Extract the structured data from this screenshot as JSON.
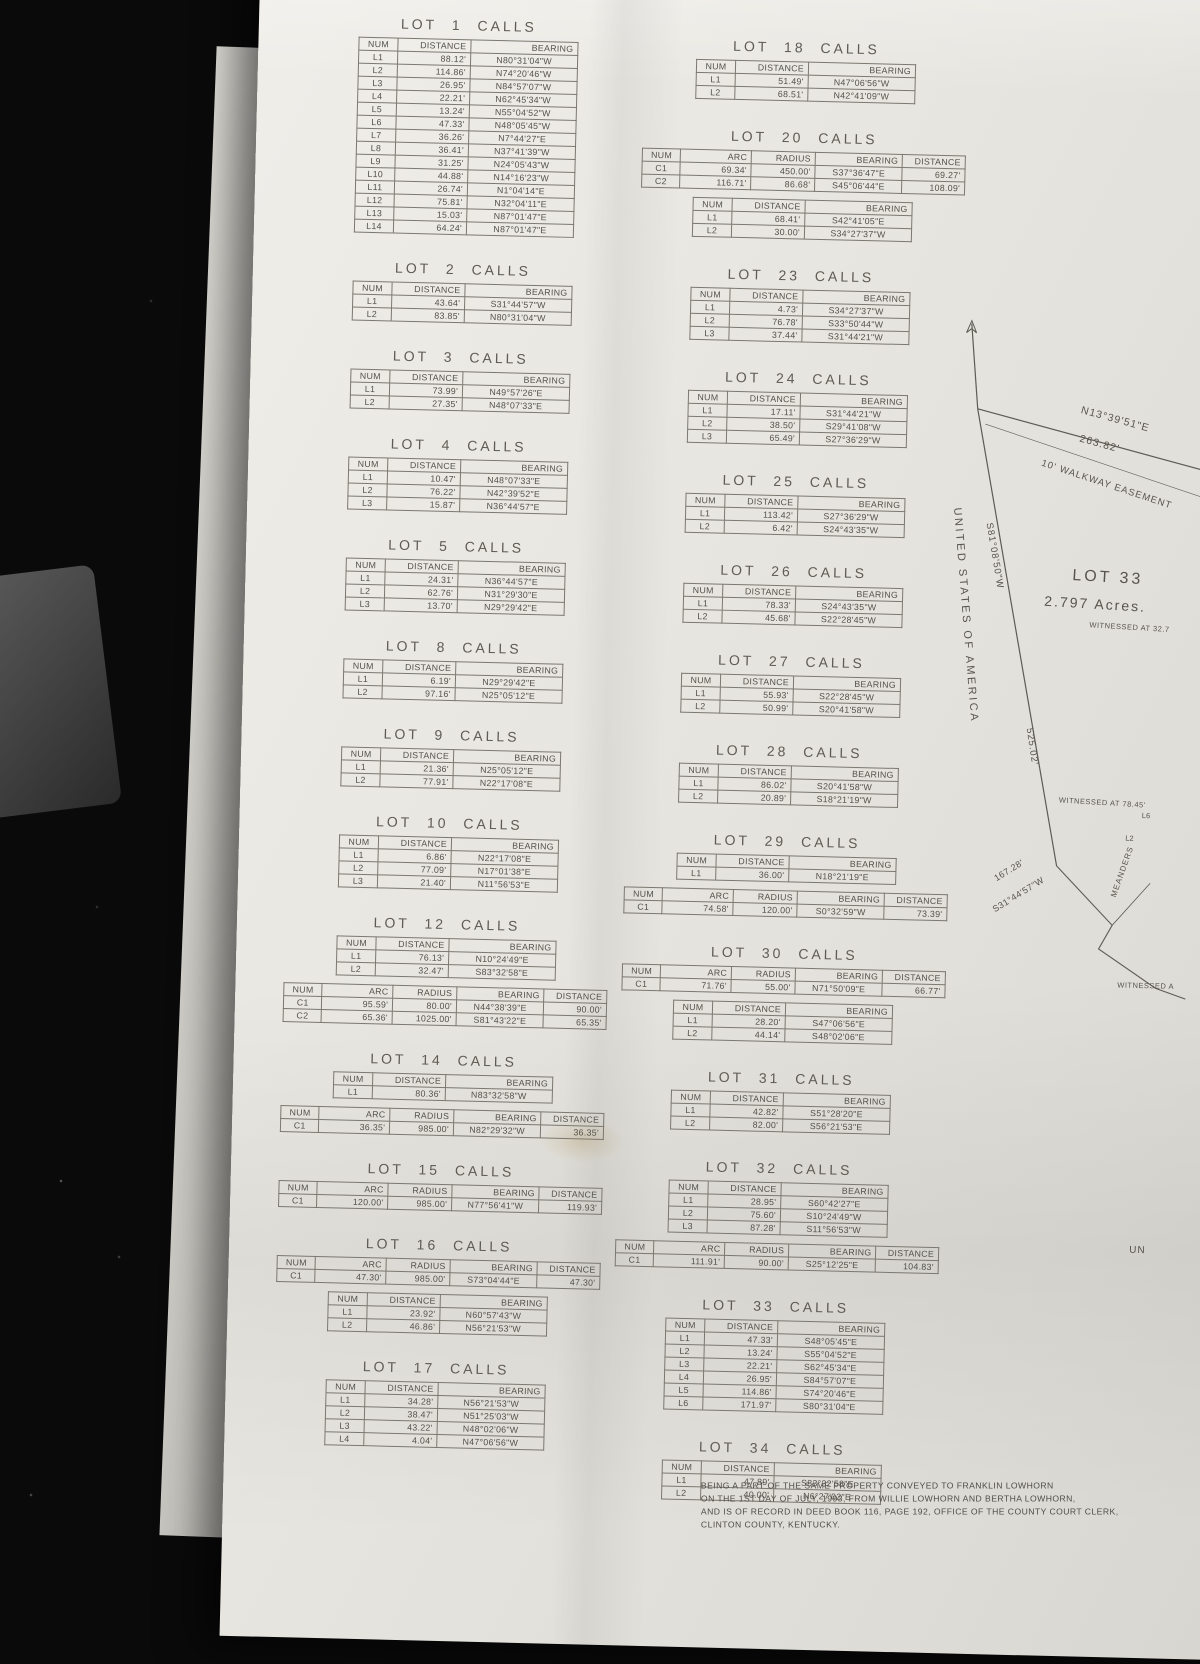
{
  "colors": {
    "background": "#0a0a0a",
    "paper": "#e7e5df",
    "ink": "#53514a",
    "table_border": "#7a786f"
  },
  "headers": {
    "line": [
      "NUM",
      "DISTANCE",
      "BEARING"
    ],
    "curve": [
      "NUM",
      "ARC",
      "RADIUS",
      "BEARING",
      "DISTANCE"
    ]
  },
  "lots": [
    {
      "title": "LOT 1 CALLS",
      "column": 1,
      "tables": [
        {
          "kind": "line",
          "rows": [
            [
              "L1",
              "88.12'",
              "N80°31'04\"W"
            ],
            [
              "L2",
              "114.86'",
              "N74°20'46\"W"
            ],
            [
              "L3",
              "26.95'",
              "N84°57'07\"W"
            ],
            [
              "L4",
              "22.21'",
              "N62°45'34\"W"
            ],
            [
              "L5",
              "13.24'",
              "N55°04'52\"W"
            ],
            [
              "L6",
              "47.33'",
              "N48°05'45\"W"
            ],
            [
              "L7",
              "36.26'",
              "N7°44'27\"E"
            ],
            [
              "L8",
              "36.41'",
              "N37°41'39\"W"
            ],
            [
              "L9",
              "31.25'",
              "N24°05'43\"W"
            ],
            [
              "L10",
              "44.88'",
              "N14°16'23\"W"
            ],
            [
              "L11",
              "26.74'",
              "N1°04'14\"E"
            ],
            [
              "L12",
              "75.81'",
              "N32°04'11\"E"
            ],
            [
              "L13",
              "15.03'",
              "N87°01'47\"E"
            ],
            [
              "L14",
              "64.24'",
              "N87°01'47\"E"
            ]
          ]
        }
      ]
    },
    {
      "title": "LOT 2 CALLS",
      "column": 1,
      "tables": [
        {
          "kind": "line",
          "rows": [
            [
              "L1",
              "43.64'",
              "S31°44'57\"W"
            ],
            [
              "L2",
              "83.85'",
              "N80°31'04\"W"
            ]
          ]
        }
      ]
    },
    {
      "title": "LOT 3 CALLS",
      "column": 1,
      "tables": [
        {
          "kind": "line",
          "rows": [
            [
              "L1",
              "73.99'",
              "N49°57'26\"E"
            ],
            [
              "L2",
              "27.35'",
              "N48°07'33\"E"
            ]
          ]
        }
      ]
    },
    {
      "title": "LOT 4 CALLS",
      "column": 1,
      "tables": [
        {
          "kind": "line",
          "rows": [
            [
              "L1",
              "10.47'",
              "N48°07'33\"E"
            ],
            [
              "L2",
              "76.22'",
              "N42°39'52\"E"
            ],
            [
              "L3",
              "15.87'",
              "N36°44'57\"E"
            ]
          ]
        }
      ]
    },
    {
      "title": "LOT 5 CALLS",
      "column": 1,
      "tables": [
        {
          "kind": "line",
          "rows": [
            [
              "L1",
              "24.31'",
              "N36°44'57\"E"
            ],
            [
              "L2",
              "62.76'",
              "N31°29'30\"E"
            ],
            [
              "L3",
              "13.70'",
              "N29°29'42\"E"
            ]
          ]
        }
      ]
    },
    {
      "title": "LOT 8 CALLS",
      "column": 1,
      "tables": [
        {
          "kind": "line",
          "rows": [
            [
              "L1",
              "6.19'",
              "N29°29'42\"E"
            ],
            [
              "L2",
              "97.16'",
              "N25°05'12\"E"
            ]
          ]
        }
      ]
    },
    {
      "title": "LOT 9 CALLS",
      "column": 1,
      "tables": [
        {
          "kind": "line",
          "rows": [
            [
              "L1",
              "21.36'",
              "N25°05'12\"E"
            ],
            [
              "L2",
              "77.91'",
              "N22°17'08\"E"
            ]
          ]
        }
      ]
    },
    {
      "title": "LOT 10 CALLS",
      "column": 1,
      "tables": [
        {
          "kind": "line",
          "rows": [
            [
              "L1",
              "6.86'",
              "N22°17'08\"E"
            ],
            [
              "L2",
              "77.09'",
              "N17°01'38\"E"
            ],
            [
              "L3",
              "21.40'",
              "N11°56'53\"E"
            ]
          ]
        }
      ]
    },
    {
      "title": "LOT 12 CALLS",
      "column": 1,
      "tables": [
        {
          "kind": "line",
          "rows": [
            [
              "L1",
              "76.13'",
              "N10°24'49\"E"
            ],
            [
              "L2",
              "32.47'",
              "S83°32'58\"E"
            ]
          ]
        },
        {
          "kind": "curve",
          "rows": [
            [
              "C1",
              "95.59'",
              "80.00'",
              "N44°38'39\"E",
              "90.00'"
            ],
            [
              "C2",
              "65.36'",
              "1025.00'",
              "S81°43'22\"E",
              "65.35'"
            ]
          ]
        }
      ]
    },
    {
      "title": "LOT 14 CALLS",
      "column": 1,
      "tables": [
        {
          "kind": "line",
          "rows": [
            [
              "L1",
              "80.36'",
              "N83°32'58\"W"
            ]
          ]
        },
        {
          "kind": "curve",
          "rows": [
            [
              "C1",
              "36.35'",
              "985.00'",
              "N82°29'32\"W",
              "36.35'"
            ]
          ]
        }
      ]
    },
    {
      "title": "LOT 15 CALLS",
      "column": 1,
      "tables": [
        {
          "kind": "curve",
          "rows": [
            [
              "C1",
              "120.00'",
              "985.00'",
              "N77°56'41\"W",
              "119.93'"
            ]
          ]
        }
      ]
    },
    {
      "title": "LOT 16 CALLS",
      "column": 1,
      "tables": [
        {
          "kind": "curve",
          "rows": [
            [
              "C1",
              "47.30'",
              "985.00'",
              "S73°04'44\"E",
              "47.30'"
            ]
          ]
        },
        {
          "kind": "line",
          "rows": [
            [
              "L1",
              "23.92'",
              "N60°57'43\"W"
            ],
            [
              "L2",
              "46.86'",
              "N56°21'53\"W"
            ]
          ]
        }
      ]
    },
    {
      "title": "LOT 17 CALLS",
      "column": 1,
      "tables": [
        {
          "kind": "line",
          "rows": [
            [
              "L1",
              "34.28'",
              "N56°21'53\"W"
            ],
            [
              "L2",
              "38.47'",
              "N51°25'03\"W"
            ],
            [
              "L3",
              "43.22'",
              "N48°02'06\"W"
            ],
            [
              "L4",
              "4.04'",
              "N47°06'56\"W"
            ]
          ]
        }
      ]
    },
    {
      "title": "LOT 18 CALLS",
      "column": 2,
      "tables": [
        {
          "kind": "line",
          "rows": [
            [
              "L1",
              "51.49'",
              "N47°06'56\"W"
            ],
            [
              "L2",
              "68.51'",
              "N42°41'09\"W"
            ]
          ]
        }
      ]
    },
    {
      "title": "LOT 20 CALLS",
      "column": 2,
      "tables": [
        {
          "kind": "curve",
          "rows": [
            [
              "C1",
              "69.34'",
              "450.00'",
              "S37°36'47\"E",
              "69.27'"
            ],
            [
              "C2",
              "116.71'",
              "86.68'",
              "S45°06'44\"E",
              "108.09'"
            ]
          ]
        },
        {
          "kind": "line",
          "rows": [
            [
              "L1",
              "68.41'",
              "S42°41'05\"E"
            ],
            [
              "L2",
              "30.00'",
              "S34°27'37\"W"
            ]
          ]
        }
      ]
    },
    {
      "title": "LOT 23 CALLS",
      "column": 2,
      "tables": [
        {
          "kind": "line",
          "rows": [
            [
              "L1",
              "4.73'",
              "S34°27'37\"W"
            ],
            [
              "L2",
              "76.78'",
              "S33°50'44\"W"
            ],
            [
              "L3",
              "37.44'",
              "S31°44'21\"W"
            ]
          ]
        }
      ]
    },
    {
      "title": "LOT 24 CALLS",
      "column": 2,
      "tables": [
        {
          "kind": "line",
          "rows": [
            [
              "L1",
              "17.11'",
              "S31°44'21\"W"
            ],
            [
              "L2",
              "38.50'",
              "S29°41'08\"W"
            ],
            [
              "L3",
              "65.49'",
              "S27°36'29\"W"
            ]
          ]
        }
      ]
    },
    {
      "title": "LOT 25 CALLS",
      "column": 2,
      "tables": [
        {
          "kind": "line",
          "rows": [
            [
              "L1",
              "113.42'",
              "S27°36'29\"W"
            ],
            [
              "L2",
              "6.42'",
              "S24°43'35\"W"
            ]
          ]
        }
      ]
    },
    {
      "title": "LOT 26 CALLS",
      "column": 2,
      "tables": [
        {
          "kind": "line",
          "rows": [
            [
              "L1",
              "78.33'",
              "S24°43'35\"W"
            ],
            [
              "L2",
              "45.68'",
              "S22°28'45\"W"
            ]
          ]
        }
      ]
    },
    {
      "title": "LOT 27 CALLS",
      "column": 2,
      "tables": [
        {
          "kind": "line",
          "rows": [
            [
              "L1",
              "55.93'",
              "S22°28'45\"W"
            ],
            [
              "L2",
              "50.99'",
              "S20°41'58\"W"
            ]
          ]
        }
      ]
    },
    {
      "title": "LOT 28 CALLS",
      "column": 2,
      "tables": [
        {
          "kind": "line",
          "rows": [
            [
              "L1",
              "86.02'",
              "S20°41'58\"W"
            ],
            [
              "L2",
              "20.89'",
              "S18°21'19\"W"
            ]
          ]
        }
      ]
    },
    {
      "title": "LOT 29 CALLS",
      "column": 2,
      "tables": [
        {
          "kind": "line",
          "rows": [
            [
              "L1",
              "36.00'",
              "N18°21'19\"E"
            ]
          ]
        },
        {
          "kind": "curve",
          "rows": [
            [
              "C1",
              "74.58'",
              "120.00'",
              "S0°32'59\"W",
              "73.39'"
            ]
          ]
        }
      ]
    },
    {
      "title": "LOT 30 CALLS",
      "column": 2,
      "tables": [
        {
          "kind": "curve",
          "rows": [
            [
              "C1",
              "71.76'",
              "55.00'",
              "N71°50'09\"E",
              "66.77'"
            ]
          ]
        },
        {
          "kind": "line",
          "rows": [
            [
              "L1",
              "28.20'",
              "S47°06'56\"E"
            ],
            [
              "L2",
              "44.14'",
              "S48°02'06\"E"
            ]
          ]
        }
      ]
    },
    {
      "title": "LOT 31 CALLS",
      "column": 2,
      "tables": [
        {
          "kind": "line",
          "rows": [
            [
              "L1",
              "42.82'",
              "S51°28'20\"E"
            ],
            [
              "L2",
              "82.00'",
              "S56°21'53\"E"
            ]
          ]
        }
      ]
    },
    {
      "title": "LOT 32 CALLS",
      "column": 2,
      "tables": [
        {
          "kind": "line",
          "rows": [
            [
              "L1",
              "28.95'",
              "S60°42'27\"E"
            ],
            [
              "L2",
              "75.60'",
              "S10°24'49\"W"
            ],
            [
              "L3",
              "87.28'",
              "S11°56'53\"W"
            ]
          ]
        },
        {
          "kind": "curve",
          "rows": [
            [
              "C1",
              "111.91'",
              "90.00'",
              "S25°12'25\"E",
              "104.83'"
            ]
          ]
        }
      ]
    },
    {
      "title": "LOT 33 CALLS",
      "column": 2,
      "tables": [
        {
          "kind": "line",
          "rows": [
            [
              "L1",
              "47.33'",
              "S48°05'45\"E"
            ],
            [
              "L2",
              "13.24'",
              "S55°04'52\"E"
            ],
            [
              "L3",
              "22.21'",
              "S62°45'34\"E"
            ],
            [
              "L4",
              "26.95'",
              "S84°57'07\"E"
            ],
            [
              "L5",
              "114.86'",
              "S74°20'46\"E"
            ],
            [
              "L6",
              "171.97'",
              "S80°31'04\"E"
            ]
          ]
        }
      ]
    },
    {
      "title": "LOT 34 CALLS",
      "column": 2,
      "tables": [
        {
          "kind": "line",
          "rows": [
            [
              "L1",
              "47.89'",
              "S83°32'58\"E"
            ],
            [
              "L2",
              "40.00'",
              "N6°27'02\"E"
            ]
          ]
        }
      ]
    }
  ],
  "map": {
    "north_bearing": "N13°39'51\"E",
    "north_distance": "263.82'",
    "easement_label": "10' WALKWAY EASEMENT",
    "west_bearing": "S81°08'50\"W",
    "owner_label": "UNITED STATES OF AMERICA",
    "lot_number": "LOT 33",
    "lot_acres": "2.797  Acres.",
    "witnessed_1": "WITNESSED AT 32.7",
    "witnessed_2": "WITNESSED AT 78.45'",
    "witnessed_3": "WITNESSED A",
    "south_distance": "525.02'",
    "meander_distance": "167.28'",
    "meander_bearing": "S31°44'57\"W",
    "meanders_label": "MEANDERS",
    "point_l6": "L6",
    "point_l2": "L2",
    "edge_fragment": "UN"
  },
  "footer": {
    "lines": [
      "BEING A PART OF THE SAME PROPERTY CONVEYED TO FRANKLIN LOWHORN",
      "ON THE 1ST DAY OF JULY, 1993, FROM WILLIE LOWHORN AND BERTHA LOWHORN,",
      "AND IS OF RECORD IN DEED BOOK 116, PAGE 192, OFFICE OF THE COUNTY COURT CLERK,",
      "CLINTON COUNTY, KENTUCKY."
    ]
  }
}
